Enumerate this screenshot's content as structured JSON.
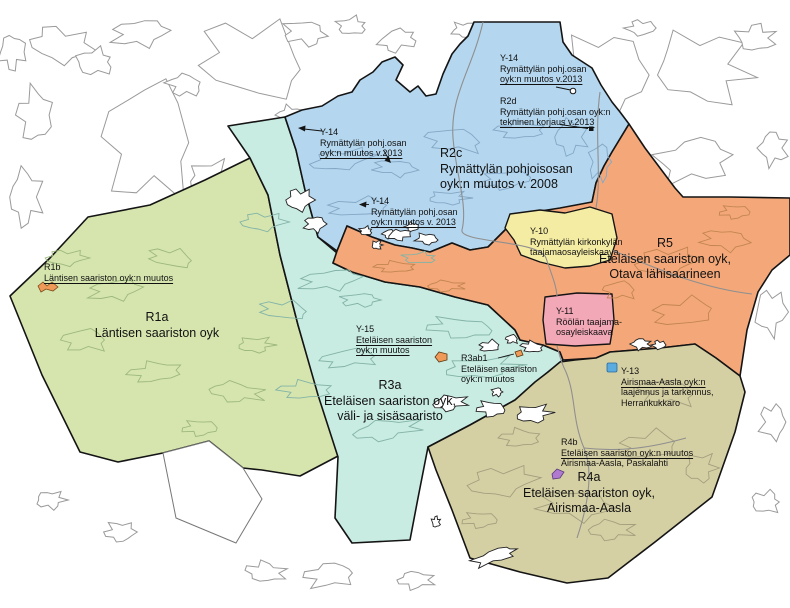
{
  "map": {
    "description": "Municipal master plan (osayleiskaava) index map of the Rymättylä / southern archipelago area"
  },
  "colors": {
    "background": "#ffffff",
    "boundary": "#141414",
    "base_island_outline": "#9a9a9a",
    "road": "#8f8f8f",
    "region_blue": "#b4d6ee",
    "region_teal": "#c8ebe2",
    "region_green": "#d6e5ae",
    "region_orange": "#f4a87a",
    "region_yellow": "#f5eca4",
    "region_pink": "#f3a8b7",
    "region_olive": "#d5d0a4",
    "marker_blue": "#5aabdf",
    "marker_purple": "#b07ad0",
    "marker_orange": "#ef9a58"
  },
  "labels": {
    "r2c": {
      "code": "R2c",
      "line1": "Rymättylän pohjoisosan",
      "line2": "oyk:n muutos v. 2008"
    },
    "r5": {
      "code": "R5",
      "line1": "Eteläisen saariston oyk,",
      "line2": "Otava lähisaarineen"
    },
    "r1a": {
      "code": "R1a",
      "line1": "Läntisen saariston oyk"
    },
    "r3a": {
      "code": "R3a",
      "line1": "Eteläisen saariston oyk,",
      "line2": "väli- ja sisäsaaristo"
    },
    "r4a": {
      "code": "R4a",
      "line1": "Eteläisen saariston oyk,",
      "line2": "Airismaa-Aasla"
    },
    "y14_top": {
      "code": "Y-14",
      "line1": "Rymättylän pohj.osan",
      "line2": "oyk:n muutos v.2013"
    },
    "r2d": {
      "code": "R2d",
      "line1": "Rymättylän pohj.osan oyk:n",
      "line2": "tekninen korjaus v.2013"
    },
    "y14_left": {
      "code": "Y-14",
      "line1": "Rymättylän pohj.osan",
      "line2": "oyk:n muutos v.2013"
    },
    "y14_mid": {
      "code": "Y-14",
      "line1": "Rymättylän pohj.osan",
      "line2": "oyk:n muutos v. 2013"
    },
    "y10": {
      "code": "Y-10",
      "line1": "Rymättylän kirkonkylän",
      "line2": "taajamaosayleiskaava"
    },
    "y11": {
      "code": "Y-11",
      "line1": "Röölän taajama-",
      "line2": "osayleiskaava"
    },
    "r1b": {
      "code": "R1b",
      "line1": "Läntisen saariston oyk:n muutos"
    },
    "y15": {
      "code": "Y-15",
      "line1": "Eteläisen saariston",
      "line2": "oyk:n muutos"
    },
    "r3ab1": {
      "code": "R3ab1",
      "line1": "Eteläisen saariston",
      "line2": "oyk:n muutos"
    },
    "y13": {
      "code": "Y-13",
      "line1": "Airismaa-Aasla oyk:n",
      "line2": "laajennus ja tarkennus,",
      "line3": "Herrankukkaro"
    },
    "r4b": {
      "code": "R4b",
      "line1": "Eteläisen saariston oyk:n muutos",
      "line2": "Airismaa-Aasla, Paskalahti"
    }
  }
}
